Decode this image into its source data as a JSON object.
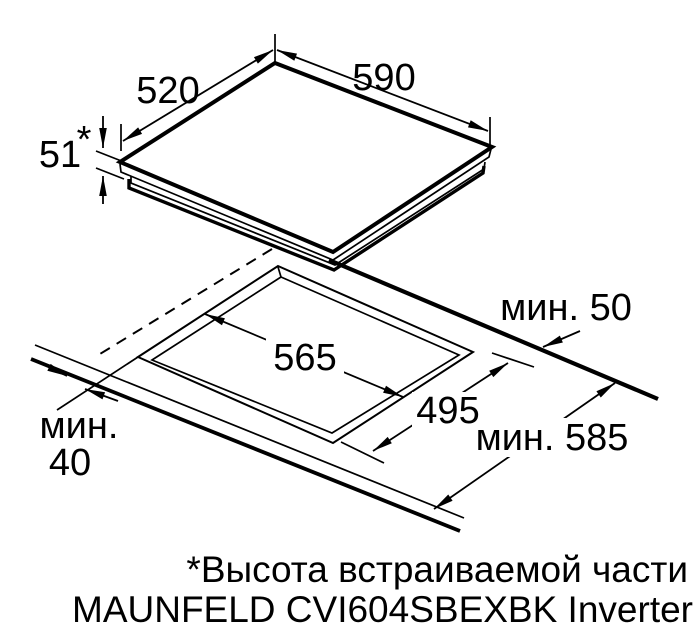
{
  "figure": {
    "kind": "hob-installation-diagram",
    "colors": {
      "line": "#000000",
      "background": "#ffffff"
    },
    "appliance": {
      "width": "590",
      "depth": "520",
      "height": "51",
      "height_note_marker": "*"
    },
    "cutout": {
      "width": "565",
      "depth": "495"
    },
    "clearances": {
      "rear_min": "мин. 50",
      "worktop_depth_min": "мин. 585",
      "front_min_line1": "мин.",
      "front_min_line2": "40"
    },
    "footnote": {
      "height_note": "*Высота встраиваемой части",
      "model": "MAUNFELD CVI604SBEXBK Inverter"
    }
  }
}
